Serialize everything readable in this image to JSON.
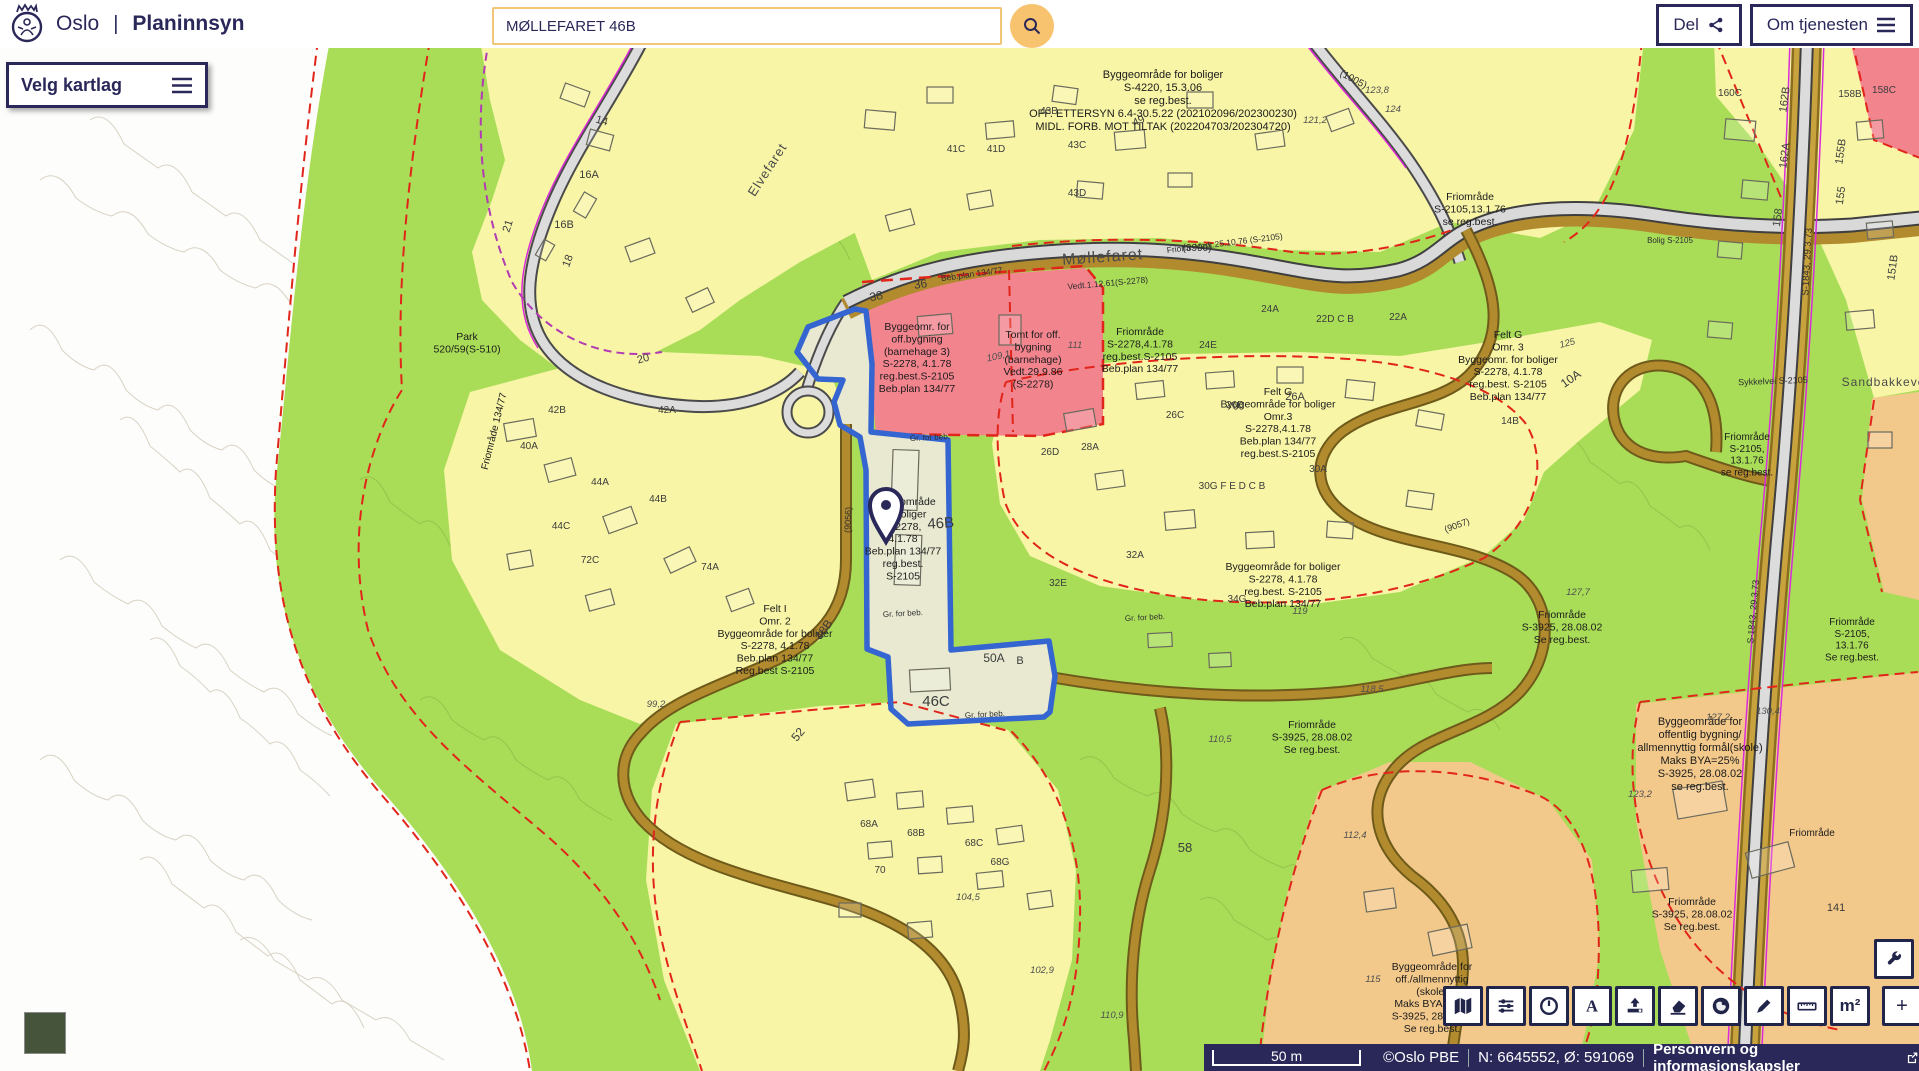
{
  "header": {
    "logo": "oslo-coat-of-arms",
    "city": "Oslo",
    "divider": "|",
    "app_title": "Planinnsyn",
    "search_value": "MØLLEFARET 46B",
    "share_label": "Del",
    "about_label": "Om tjenesten"
  },
  "map_controls": {
    "layers_label": "Velg kartlag"
  },
  "toolbar": {
    "wrench_icon": "wrench",
    "buttons": [
      {
        "name": "basemap",
        "icon": "map"
      },
      {
        "name": "layer-filter",
        "icon": "sliders"
      },
      {
        "name": "history",
        "icon": "clock"
      },
      {
        "name": "text-tool",
        "icon": "letter-a"
      },
      {
        "name": "export",
        "icon": "upload"
      },
      {
        "name": "eraser",
        "icon": "eraser"
      },
      {
        "name": "globe",
        "icon": "globe"
      },
      {
        "name": "draw",
        "icon": "pencil"
      },
      {
        "name": "measure-length",
        "icon": "ruler"
      },
      {
        "name": "measure-area",
        "icon": "m2",
        "text": "m²"
      },
      {
        "name": "zoom-in",
        "icon": "plus",
        "text": "+",
        "group": "zoom"
      },
      {
        "name": "zoom-out",
        "icon": "minus",
        "text": "−",
        "group": "zoom"
      }
    ]
  },
  "statusbar": {
    "scale": "50 m",
    "attribution": "©Oslo PBE",
    "coordinates": "N: 6645552, Ø: 591069",
    "privacy": "Personvern og informasjonskapsler"
  },
  "map": {
    "selected_parcel": "MØLLEFARET 46B",
    "colors": {
      "residential_yellow": "#f8f5a6",
      "green_area": "#a9dd58",
      "public_pink": "#f2848e",
      "school_orange": "#f3c98b",
      "selection_blue": "#3465d0",
      "navy": "#2a2859",
      "accent_orange": "#f8c36e"
    },
    "labels": [
      {
        "t": "Byggeområde for boliger\nS-4220, 15.3.06\nse reg.best.\nOFF. ETTERSYN 6.4-30.5.22 (202102096/202300230)\nMIDL. FORB. MOT TILTAK (202204703/202304720)",
        "x": 1163,
        "y": 78,
        "s": 11
      },
      {
        "t": "Byggeomr. for\noff.bygning\n(barnehage 3)\nS-2278, 4.1.78\nreg.best.S-2105\nBeb.plan 134/77",
        "x": 917,
        "y": 330,
        "s": 10.5
      },
      {
        "t": "Tomt for off.\nbygning\n(barnehage)\nVedt.29.9.86\n(S-2278)",
        "x": 1033,
        "y": 338,
        "s": 10.5
      },
      {
        "t": "Friområde\nS-2278,4.1.78\nreg.best.S-2105\nBeb.plan 134/77",
        "x": 1140,
        "y": 335,
        "s": 10.5
      },
      {
        "t": "Byggeområde\nfor boliger\nS-2278,\n4.1.78\nBeb.plan 134/77\nreg.best.\nS-2105",
        "x": 903,
        "y": 505,
        "s": 10.5
      },
      {
        "t": "Felt G\nByggeområde for boliger\nOmr.3\nS-2278,4.1.78\nBeb.plan 134/77\nreg.best.S-2105",
        "x": 1278,
        "y": 395,
        "s": 10.5
      },
      {
        "t": "Felt G\nOmr. 3\nByggeomr. for boliger\nS-2278, 4.1.78\nreg.best. S-2105\nBeb.plan 134/77",
        "x": 1508,
        "y": 338,
        "s": 10.5
      },
      {
        "t": "Felt I\nOmr. 2\nByggeområde for boliger\nS-2278, 4.1.78\nBeb.plan 134/77\nReg.best S-2105",
        "x": 775,
        "y": 612,
        "s": 10.5
      },
      {
        "t": "Byggeområde for boliger\nS-2278, 4.1.78\nreg.best. S-2105\nBeb.plan 134/77",
        "x": 1283,
        "y": 570,
        "s": 10.5
      },
      {
        "t": "Park\n520/59(S-510)",
        "x": 467,
        "y": 340,
        "s": 10.5
      },
      {
        "t": "Friområde 134/77",
        "x": 497,
        "y": 432,
        "s": 10,
        "r": -76
      },
      {
        "t": "Friområde\nS-2105,13.1.76\nse reg.best.",
        "x": 1470,
        "y": 200,
        "s": 10.5
      },
      {
        "t": "Friomr. Vedt.25.10.76 (S-2105)",
        "x": 1225,
        "y": 246,
        "s": 8.5,
        "r": -7,
        "st": "ref"
      },
      {
        "t": "Friområde\nS-2105,\n13.1.76\nse reg.best.",
        "x": 1747,
        "y": 440,
        "s": 10
      },
      {
        "t": "Friområde\nS-2105,\n13.1.76\nSe reg.best.",
        "x": 1852,
        "y": 625,
        "s": 10
      },
      {
        "t": "Friområde\nS-3925, 28.08.02\nSe reg.best.",
        "x": 1562,
        "y": 618,
        "s": 10.5
      },
      {
        "t": "Friområde\nS-3925, 28.08.02\nSe reg.best.",
        "x": 1312,
        "y": 728,
        "s": 10.5
      },
      {
        "t": "Friområde\nS-3925, 28.08.02\nSe reg.best.",
        "x": 1692,
        "y": 905,
        "s": 10.5
      },
      {
        "t": "Friområde",
        "x": 1812,
        "y": 836,
        "s": 10
      },
      {
        "t": "Byggeområde for\noffentlig bygning/\nallmennyttig formål(skole)\nMaks BYA=25%\nS-3925, 28.08.02\nse reg.best.",
        "x": 1700,
        "y": 725,
        "s": 11
      },
      {
        "t": "Byggeområde for\noff./allmennyttig\n(skole)\nMaks BYA=25%\nS-3925, 28.08.02\nSe reg.best.",
        "x": 1432,
        "y": 970,
        "s": 10.5
      },
      {
        "t": "Møllefaret",
        "x": 1103,
        "y": 262,
        "s": 16,
        "r": -4,
        "st": "road"
      },
      {
        "t": "Elvefaret",
        "x": 771,
        "y": 172,
        "s": 13,
        "r": -57,
        "st": "road"
      },
      {
        "t": "Sandbakkeveien",
        "x": 1893,
        "y": 386,
        "s": 12,
        "st": "road"
      },
      {
        "t": "Sykkelvei S-2105",
        "x": 1773,
        "y": 384,
        "s": 9,
        "r": -2,
        "st": "ref"
      },
      {
        "t": "S-1843,  29.3.73",
        "x": 1810,
        "y": 262,
        "s": 9.5,
        "r": -87,
        "st": "ref"
      },
      {
        "t": "S-1843, 29.3.73",
        "x": 1756,
        "y": 612,
        "s": 9,
        "r": -85,
        "st": "ref"
      },
      {
        "t": "(3990)",
        "x": 1197,
        "y": 251,
        "s": 10,
        "st": "ref"
      },
      {
        "t": "(1005)",
        "x": 1352,
        "y": 82,
        "s": 10,
        "r": 28,
        "st": "ref"
      },
      {
        "t": "(9056)",
        "x": 851,
        "y": 520,
        "s": 9,
        "r": -88,
        "st": "ref"
      },
      {
        "t": "(9057)",
        "x": 1458,
        "y": 528,
        "s": 9,
        "r": -20,
        "st": "ref"
      },
      {
        "t": "Beb.plan 134/77",
        "x": 972,
        "y": 277,
        "s": 8.5,
        "r": -8,
        "st": "ref"
      },
      {
        "t": "Vedt.1.12.61(S-2278)",
        "x": 1108,
        "y": 286,
        "s": 8.5,
        "r": -5,
        "st": "ref"
      },
      {
        "t": "Bolig S-2105",
        "x": 1670,
        "y": 243,
        "s": 8,
        "st": "ref"
      },
      {
        "t": "Gr. for beb.",
        "x": 930,
        "y": 440,
        "s": 8,
        "r": -3,
        "st": "ref"
      },
      {
        "t": "Gr. for beb.",
        "x": 903,
        "y": 616,
        "s": 8,
        "r": -3,
        "st": "ref"
      },
      {
        "t": "Gr. for beb.",
        "x": 985,
        "y": 717,
        "s": 8,
        "r": -3,
        "st": "ref"
      },
      {
        "t": "Gr. for beb.",
        "x": 1145,
        "y": 620,
        "s": 8,
        "r": -3,
        "st": "ref"
      },
      {
        "t": "14",
        "x": 601,
        "y": 124,
        "s": 11,
        "r": 15,
        "st": "num"
      },
      {
        "t": "16A",
        "x": 589,
        "y": 178,
        "s": 11,
        "st": "num"
      },
      {
        "t": "16B",
        "x": 564,
        "y": 228,
        "s": 11,
        "st": "num"
      },
      {
        "t": "18",
        "x": 571,
        "y": 262,
        "s": 11,
        "r": -70,
        "st": "num"
      },
      {
        "t": "20",
        "x": 644,
        "y": 362,
        "s": 11,
        "r": -15,
        "st": "num"
      },
      {
        "t": "21",
        "x": 511,
        "y": 227,
        "s": 11,
        "r": -72,
        "st": "num"
      },
      {
        "t": "36",
        "x": 921,
        "y": 288,
        "s": 12,
        "r": -8,
        "st": "num"
      },
      {
        "t": "38",
        "x": 877,
        "y": 300,
        "s": 12,
        "r": -12,
        "st": "num"
      },
      {
        "t": "41C",
        "x": 956,
        "y": 152,
        "s": 10,
        "st": "num"
      },
      {
        "t": "41D",
        "x": 996,
        "y": 152,
        "s": 10,
        "st": "num"
      },
      {
        "t": "43B",
        "x": 1049,
        "y": 114,
        "s": 10,
        "st": "num"
      },
      {
        "t": "43C",
        "x": 1077,
        "y": 148,
        "s": 10,
        "st": "num"
      },
      {
        "t": "43D",
        "x": 1077,
        "y": 196,
        "s": 10,
        "st": "num"
      },
      {
        "t": "49",
        "x": 1140,
        "y": 124,
        "s": 11,
        "r": -25,
        "st": "num"
      },
      {
        "t": "42B",
        "x": 557,
        "y": 413,
        "s": 10,
        "st": "num"
      },
      {
        "t": "42A",
        "x": 667,
        "y": 413,
        "s": 10,
        "st": "num"
      },
      {
        "t": "40A",
        "x": 529,
        "y": 449,
        "s": 10,
        "st": "num"
      },
      {
        "t": "44A",
        "x": 600,
        "y": 485,
        "s": 10,
        "st": "num"
      },
      {
        "t": "44B",
        "x": 658,
        "y": 502,
        "s": 10,
        "st": "num"
      },
      {
        "t": "44C",
        "x": 561,
        "y": 529,
        "s": 10,
        "st": "num"
      },
      {
        "t": "72C",
        "x": 590,
        "y": 563,
        "s": 10,
        "st": "num"
      },
      {
        "t": "74A",
        "x": 710,
        "y": 570,
        "s": 10,
        "st": "num"
      },
      {
        "t": "24A",
        "x": 1270,
        "y": 312,
        "s": 10,
        "st": "num"
      },
      {
        "t": "24E",
        "x": 1208,
        "y": 348,
        "s": 10,
        "st": "num"
      },
      {
        "t": "22D C B",
        "x": 1335,
        "y": 322,
        "s": 10,
        "st": "num"
      },
      {
        "t": "22A",
        "x": 1398,
        "y": 320,
        "s": 10,
        "st": "num"
      },
      {
        "t": "26D",
        "x": 1050,
        "y": 455,
        "s": 10,
        "st": "num"
      },
      {
        "t": "26C",
        "x": 1175,
        "y": 418,
        "s": 10,
        "st": "num"
      },
      {
        "t": "26B",
        "x": 1235,
        "y": 408,
        "s": 10,
        "st": "num"
      },
      {
        "t": "26A",
        "x": 1295,
        "y": 400,
        "s": 11,
        "st": "num"
      },
      {
        "t": "28A",
        "x": 1090,
        "y": 450,
        "s": 10,
        "st": "num"
      },
      {
        "t": "30A",
        "x": 1318,
        "y": 472,
        "s": 10,
        "st": "num"
      },
      {
        "t": "30G F E D C B",
        "x": 1232,
        "y": 489,
        "s": 10,
        "st": "num"
      },
      {
        "t": "32A",
        "x": 1135,
        "y": 558,
        "s": 10,
        "st": "num"
      },
      {
        "t": "32E",
        "x": 1058,
        "y": 586,
        "s": 10,
        "st": "num"
      },
      {
        "t": "34G",
        "x": 1237,
        "y": 602,
        "s": 10,
        "st": "num"
      },
      {
        "t": "10A",
        "x": 1573,
        "y": 382,
        "s": 12,
        "r": -35,
        "st": "num"
      },
      {
        "t": "14B",
        "x": 1510,
        "y": 424,
        "s": 10,
        "st": "num"
      },
      {
        "t": "46B",
        "x": 941,
        "y": 528,
        "s": 15,
        "r": -4,
        "st": "num"
      },
      {
        "t": "46C",
        "x": 936,
        "y": 706,
        "s": 15,
        "st": "num"
      },
      {
        "t": "48B",
        "x": 827,
        "y": 632,
        "s": 12,
        "r": -55,
        "st": "num"
      },
      {
        "t": "50A",
        "x": 994,
        "y": 662,
        "s": 12,
        "st": "num"
      },
      {
        "t": "B",
        "x": 1020,
        "y": 664,
        "s": 11,
        "st": "num"
      },
      {
        "t": "52",
        "x": 801,
        "y": 737,
        "s": 12,
        "r": -50,
        "st": "num"
      },
      {
        "t": "68A",
        "x": 869,
        "y": 827,
        "s": 10,
        "st": "num"
      },
      {
        "t": "68B",
        "x": 916,
        "y": 836,
        "s": 10,
        "st": "num"
      },
      {
        "t": "68C",
        "x": 974,
        "y": 846,
        "s": 10,
        "st": "num"
      },
      {
        "t": "68G",
        "x": 1000,
        "y": 865,
        "s": 10,
        "st": "num"
      },
      {
        "t": "70",
        "x": 880,
        "y": 873,
        "s": 10,
        "st": "num"
      },
      {
        "t": "58",
        "x": 1185,
        "y": 852,
        "s": 13,
        "st": "num"
      },
      {
        "t": "141",
        "x": 1836,
        "y": 911,
        "s": 11,
        "st": "num"
      },
      {
        "t": "162B",
        "x": 1788,
        "y": 100,
        "s": 11,
        "r": -82,
        "st": "num"
      },
      {
        "t": "162A",
        "x": 1788,
        "y": 156,
        "s": 11,
        "r": -82,
        "st": "num"
      },
      {
        "t": "158",
        "x": 1781,
        "y": 218,
        "s": 11,
        "r": -82,
        "st": "num"
      },
      {
        "t": "155B",
        "x": 1844,
        "y": 152,
        "s": 11,
        "r": -82,
        "st": "num"
      },
      {
        "t": "155",
        "x": 1844,
        "y": 196,
        "s": 11,
        "r": -82,
        "st": "num"
      },
      {
        "t": "151B",
        "x": 1896,
        "y": 268,
        "s": 11,
        "r": -82,
        "st": "num"
      },
      {
        "t": "158B",
        "x": 1850,
        "y": 97,
        "s": 10,
        "st": "num"
      },
      {
        "t": "158C",
        "x": 1884,
        "y": 93,
        "s": 10,
        "st": "num"
      },
      {
        "t": "160C",
        "x": 1730,
        "y": 96,
        "s": 10,
        "st": "num"
      },
      {
        "t": "99,2",
        "x": 656,
        "y": 707,
        "s": 9.5,
        "st": "elev"
      },
      {
        "t": "104,5",
        "x": 968,
        "y": 900,
        "s": 9.5,
        "st": "elev"
      },
      {
        "t": "102,9",
        "x": 1042,
        "y": 973,
        "s": 9.5,
        "st": "elev"
      },
      {
        "t": "110,9",
        "x": 1112,
        "y": 1018,
        "s": 9.5,
        "st": "elev"
      },
      {
        "t": "112,4",
        "x": 1355,
        "y": 838,
        "s": 9.5,
        "st": "elev"
      },
      {
        "t": "118,5",
        "x": 1372,
        "y": 692,
        "s": 9.5,
        "st": "elev"
      },
      {
        "t": "110,5",
        "x": 1220,
        "y": 742,
        "s": 9.5,
        "st": "elev"
      },
      {
        "t": "119",
        "x": 1300,
        "y": 614,
        "s": 9.5,
        "st": "elev"
      },
      {
        "t": "111",
        "x": 1075,
        "y": 348,
        "s": 9.5,
        "st": "elev"
      },
      {
        "t": "109,1",
        "x": 999,
        "y": 359,
        "s": 9.5,
        "r": -12,
        "st": "elev"
      },
      {
        "t": "121,2",
        "x": 1315,
        "y": 123,
        "s": 9.5,
        "st": "elev"
      },
      {
        "t": "123,8",
        "x": 1377,
        "y": 93,
        "s": 9.5,
        "st": "elev"
      },
      {
        "t": "124",
        "x": 1393,
        "y": 112,
        "s": 9.5,
        "st": "elev"
      },
      {
        "t": "125",
        "x": 1568,
        "y": 346,
        "s": 9.5,
        "r": -15,
        "st": "elev"
      },
      {
        "t": "127,7",
        "x": 1578,
        "y": 595,
        "s": 9.5,
        "st": "elev"
      },
      {
        "t": "127,2",
        "x": 1718,
        "y": 720,
        "s": 9.5,
        "st": "elev"
      },
      {
        "t": "130,4",
        "x": 1768,
        "y": 714,
        "s": 9.5,
        "st": "elev"
      },
      {
        "t": "123,2",
        "x": 1640,
        "y": 797,
        "s": 9.5,
        "st": "elev"
      },
      {
        "t": "115",
        "x": 1373,
        "y": 982,
        "s": 9.5,
        "st": "elev"
      }
    ]
  }
}
